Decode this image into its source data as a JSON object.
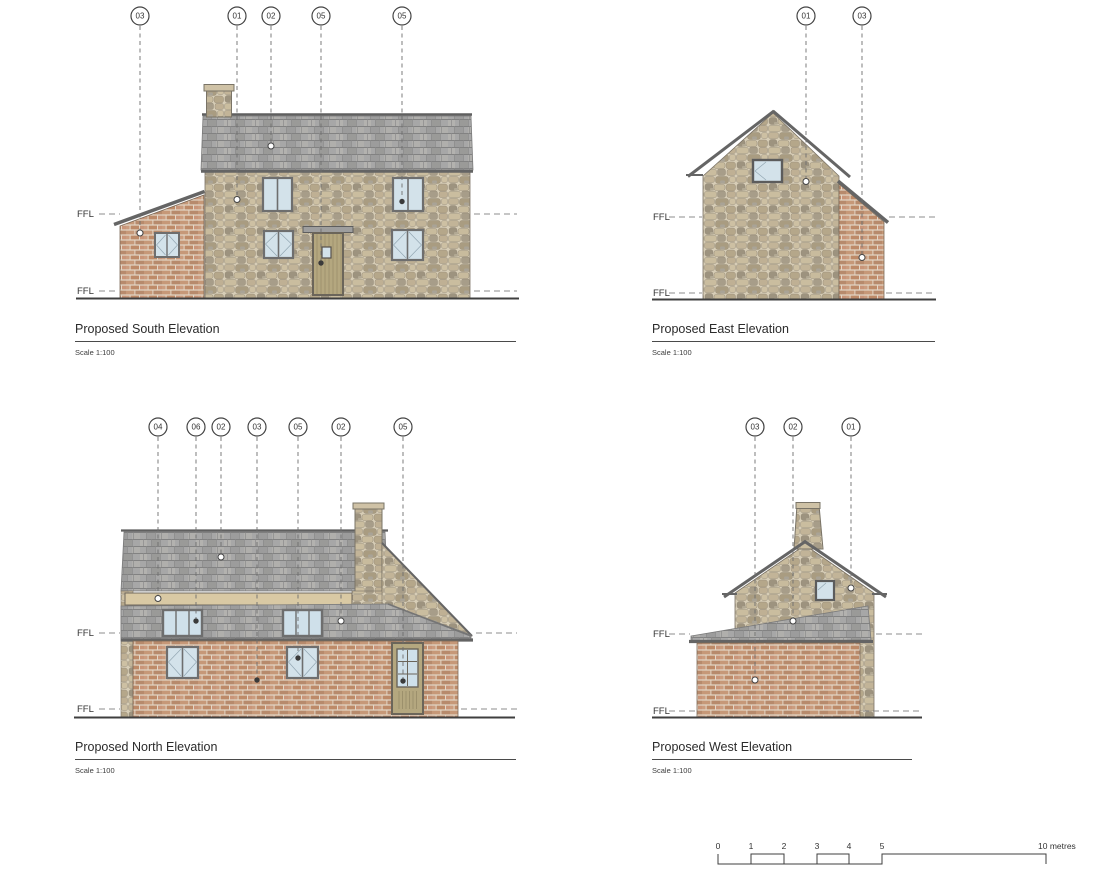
{
  "sheet": {
    "description_visible_text_only": true
  },
  "elevations": {
    "south": {
      "title": "Proposed South Elevation",
      "scale_label": "Scale 1:100",
      "ffl_labels": [
        "FFL",
        "FFL"
      ],
      "markers": [
        "03",
        "01",
        "02",
        "05",
        "05"
      ]
    },
    "east": {
      "title": "Proposed East Elevation",
      "scale_label": "Scale 1:100",
      "ffl_labels": [
        "FFL",
        "FFL"
      ],
      "markers": [
        "01",
        "03"
      ]
    },
    "north": {
      "title": "Proposed North Elevation",
      "scale_label": "Scale 1:100",
      "ffl_labels": [
        "FFL",
        "FFL"
      ],
      "markers": [
        "04",
        "06",
        "02",
        "03",
        "05",
        "02",
        "05"
      ]
    },
    "west": {
      "title": "Proposed West Elevation",
      "scale_label": "Scale 1:100",
      "ffl_labels": [
        "FFL",
        "FFL"
      ],
      "markers": [
        "03",
        "02",
        "01"
      ]
    }
  },
  "scale_bar": {
    "tick_labels": [
      "0",
      "1",
      "2",
      "3",
      "4",
      "5"
    ],
    "end_label": "10 metres"
  },
  "colors": {
    "stone": "#cdbfa2",
    "stone_mortar": "#d7cdb6",
    "brick": "#c3936f",
    "brick_mortar": "#e3d6c6",
    "slate_roof": "#a7a7a7",
    "glass": "#d3e2ea",
    "door_timber": "#b4a77f",
    "timber_band": "#d9c9a4",
    "line": "#444444"
  }
}
